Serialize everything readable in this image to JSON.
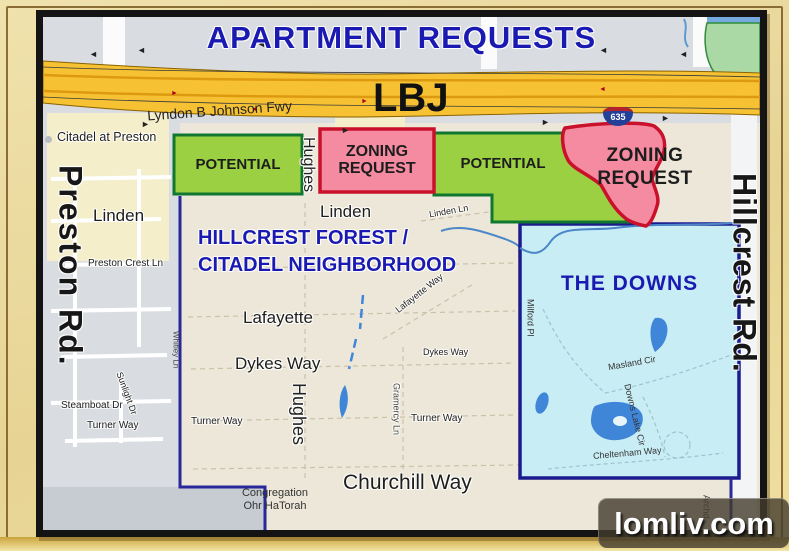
{
  "title": "APARTMENT REQUESTS",
  "watermark": "lomliv.com",
  "freeway": {
    "name_label": "Lyndon B Johnson Fwy",
    "abbrev": "LBJ",
    "shield": "635"
  },
  "zones": {
    "potential_left": "POTENTIAL",
    "zoning_left": "ZONING\nREQUEST",
    "potential_right": "POTENTIAL",
    "zoning_right": "ZONING\nREQUEST"
  },
  "areas": {
    "neighborhood_title": "HILLCREST FOREST /\nCITADEL NEIGHBORHOOD",
    "the_downs": "THE DOWNS"
  },
  "roads": {
    "preston": "Preston Rd.",
    "hillcrest": "Hillcrest Rd.",
    "hughes": "Hughes",
    "linden": "Linden",
    "linden_ln": "Linden Ln",
    "preston_crest_ln": "Preston Crest Ln",
    "lafayette": "Lafayette",
    "lafayette_way": "Lafayette Way",
    "dykes_way": "Dykes Way",
    "gramercy_ln": "Gramercy Ln",
    "whitley_ln": "Whitley Ln",
    "sunlight_dr": "Sunlight Dr",
    "steamboat_dr": "Steamboat Dr",
    "turner_way": "Turner Way",
    "churchill_way": "Churchill Way",
    "milford_pl": "Milford Pl",
    "masland_cir": "Masland Cir",
    "downs_lake_cir": "Downs Lake Cir",
    "cheltenham_way": "Cheltenham Way",
    "archduke_partial": "Archd"
  },
  "pois": {
    "citadel_at_preston": "Citadel at Preston",
    "congregation": "Congregation\nOhr HaTorah"
  },
  "icons": {
    "arrow_left": "◄",
    "arrow_right": "►"
  },
  "colors": {
    "title_blue": "#1a1ab2",
    "potential_fill": "#9bd043",
    "potential_border": "#11762f",
    "zoning_fill": "#f58ba1",
    "zoning_border": "#c9112b",
    "downs_fill": "#c9edf5",
    "downs_border": "#1b1b8e",
    "boundary_blue": "#28289a",
    "freeway_yellow": "#f6c233",
    "freeway_stripe": "#dd9a10",
    "water_blue": "#3f86d8",
    "park_green": "#abd9a5",
    "map_beige": "#ece7d8",
    "map_gray": "#d9dde1",
    "bottomleft_gray": "#c6ccd2",
    "frame_tan": "#e9d79c",
    "frame_border": "#141414"
  }
}
